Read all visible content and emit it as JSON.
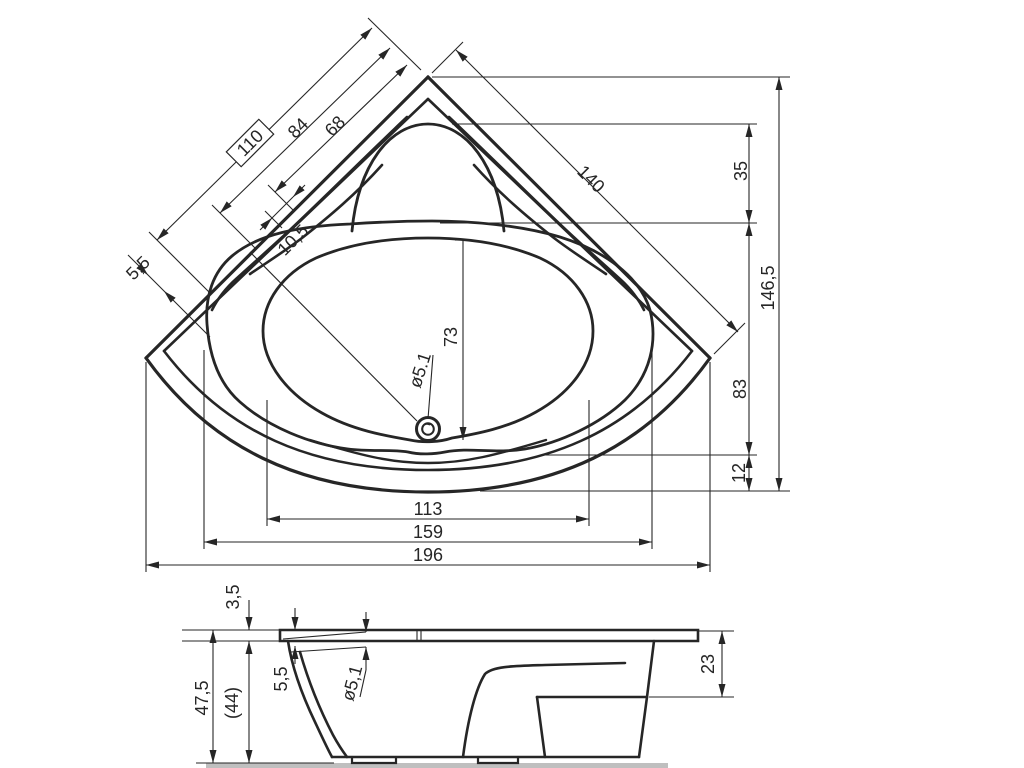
{
  "colors": {
    "background": "#ffffff",
    "line": "#262626",
    "ground_shadow": "#bfbfbf"
  },
  "dimensions": {
    "top": {
      "diag_box": "110",
      "diag_a": "84",
      "diag_b": "68",
      "diag_small": "10,5",
      "rim_thickness": "5,5",
      "edge_right": "140",
      "right_chain_1": "35",
      "right_chain_2": "83",
      "right_chain_3": "12",
      "right_total": "146,5",
      "well_length": "73",
      "drain_dia": "ø5.1",
      "width_inner": "113",
      "width_mid": "159",
      "width_total": "196"
    },
    "side": {
      "rim_thickness": "3,5",
      "height_total": "47,5",
      "height_ref": "(44)",
      "recess_depth": "5,5",
      "drain_dia": "ø5,1",
      "ledge_height": "23"
    }
  }
}
